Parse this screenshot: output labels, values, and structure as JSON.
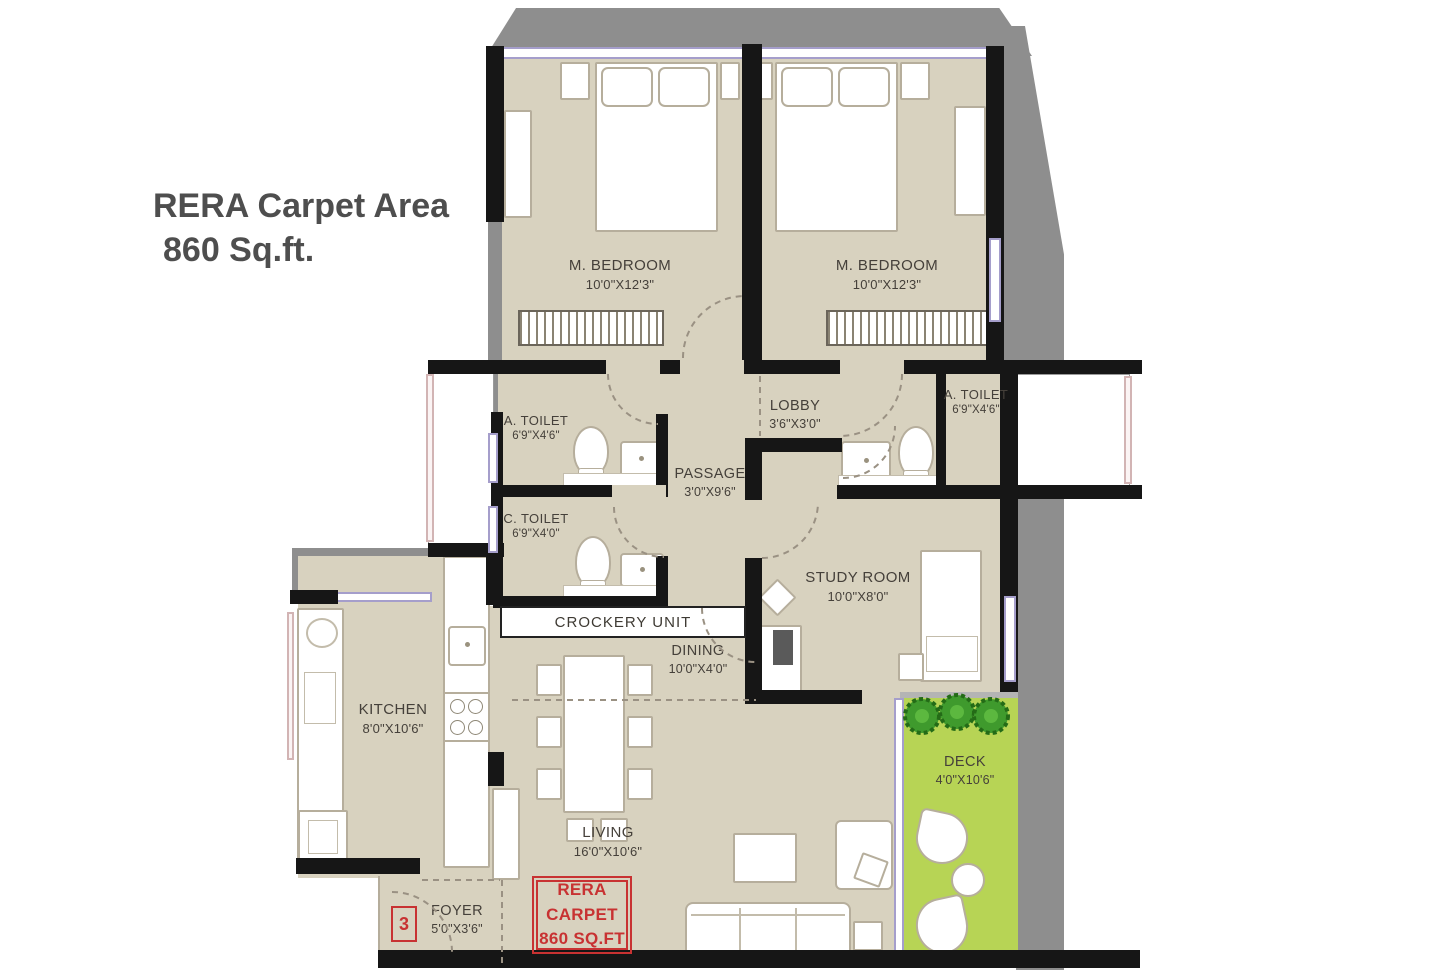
{
  "title": {
    "line1": "RERA Carpet Area",
    "line2": "860 Sq.ft."
  },
  "rooms": [
    {
      "id": "m-bedroom-1",
      "name": "M. BEDROOM",
      "dims": "10'0\"X12'3\""
    },
    {
      "id": "m-bedroom-2",
      "name": "M. BEDROOM",
      "dims": "10'0\"X12'3\""
    },
    {
      "id": "a-toilet-1",
      "name": "A. TOILET",
      "dims": "6'9\"X4'6\""
    },
    {
      "id": "a-toilet-2",
      "name": "A. TOILET",
      "dims": "6'9\"X4'6\""
    },
    {
      "id": "c-toilet",
      "name": "C. TOILET",
      "dims": "6'9\"X4'0\""
    },
    {
      "id": "lobby",
      "name": "LOBBY",
      "dims": "3'6\"X3'0\""
    },
    {
      "id": "passage",
      "name": "PASSAGE",
      "dims": "3'0\"X9'6\""
    },
    {
      "id": "study-room",
      "name": "STUDY ROOM",
      "dims": "10'0\"X8'0\""
    },
    {
      "id": "kitchen",
      "name": "KITCHEN",
      "dims": "8'0\"X10'6\""
    },
    {
      "id": "dining",
      "name": "DINING",
      "dims": "10'0\"X4'0\""
    },
    {
      "id": "living",
      "name": "LIVING",
      "dims": "16'0\"X10'6\""
    },
    {
      "id": "deck",
      "name": "DECK",
      "dims": "4'0\"X10'6\""
    },
    {
      "id": "foyer",
      "name": "FOYER",
      "dims": "5'0\"X3'6\""
    }
  ],
  "labels": {
    "crockery_unit": "CROCKERY UNIT",
    "unit_number": "3"
  },
  "rera_stamp": {
    "line1": "RERA",
    "line2": "CARPET",
    "line3": "860 SQ.FT"
  },
  "colors": {
    "floor": "#d8d2bf",
    "wall": "#161616",
    "chajja_gray": "#8e8e8e",
    "deck_green": "#b7d455",
    "tree_green": "#3f9a2d",
    "accent_red": "#c83232",
    "window_lavender": "#a59ecb",
    "label_text": "#45403a"
  }
}
